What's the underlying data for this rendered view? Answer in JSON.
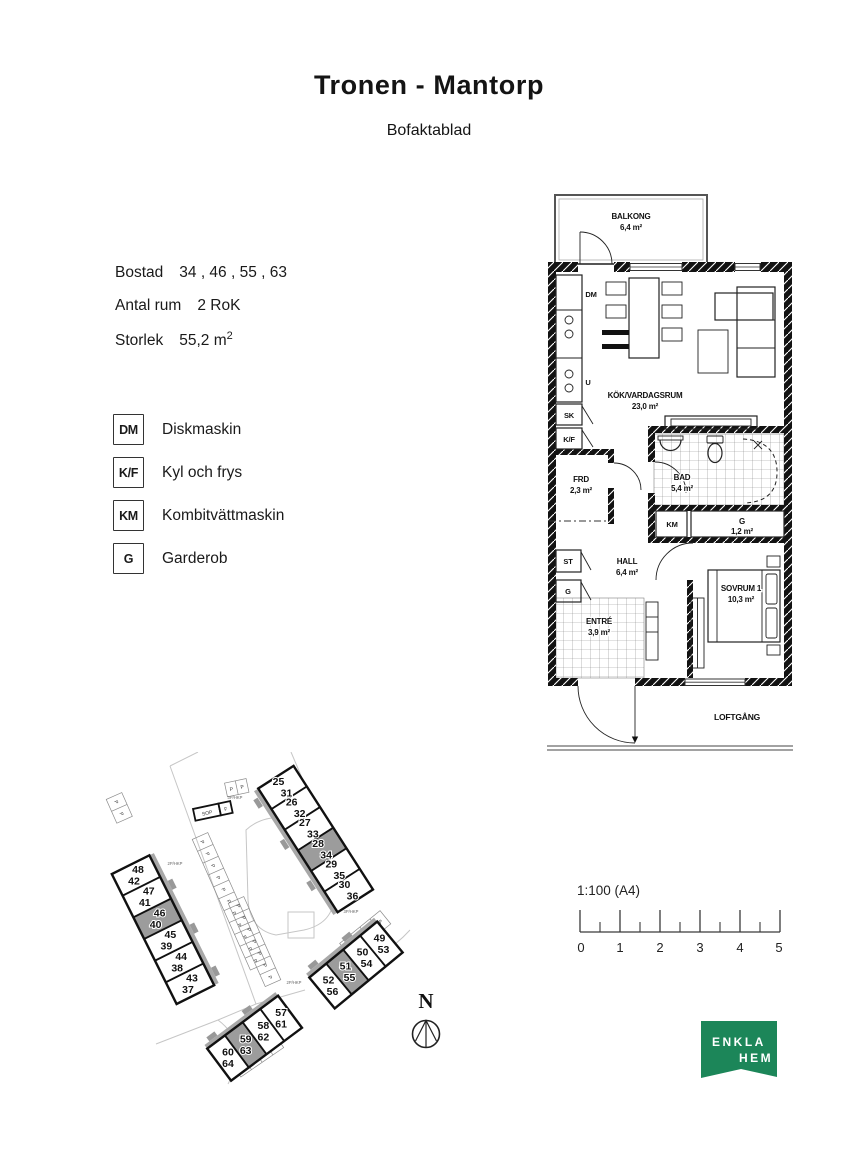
{
  "header": {
    "title": "Tronen - Mantorp",
    "subtitle": "Bofaktablad"
  },
  "info": {
    "rows": [
      {
        "label": "Bostad",
        "value": "34 , 46 , 55 , 63"
      },
      {
        "label": "Antal rum",
        "value": "2 RoK"
      },
      {
        "label": "Storlek",
        "value": "55,2 m",
        "sup": "2"
      }
    ]
  },
  "legend": {
    "items": [
      {
        "symbol": "DM",
        "label": "Diskmaskin"
      },
      {
        "symbol": "K/F",
        "label": "Kyl och frys"
      },
      {
        "symbol": "KM",
        "label": "Kombitvättmaskin"
      },
      {
        "symbol": "G",
        "label": "Garderob"
      }
    ]
  },
  "floorplan": {
    "balcony": {
      "name": "BALKONG",
      "area": "6,4 m²"
    },
    "rooms": {
      "kitchen_living": {
        "name": "KÖK/VARDAGSRUM",
        "area": "23,0 m²"
      },
      "frd": {
        "name": "FRD",
        "area": "2,3 m²"
      },
      "bath": {
        "name": "BAD",
        "area": "5,4 m²"
      },
      "closet": {
        "name": "G",
        "area": "1,2 m²"
      },
      "hall": {
        "name": "HALL",
        "area": "6,4 m²"
      },
      "bedroom": {
        "name": "SOVRUM 1",
        "area": "10,3 m²"
      },
      "entry": {
        "name": "ENTRÉ",
        "area": "3,9 m²"
      }
    },
    "fixtures": {
      "dm": "DM",
      "u": "U",
      "sk": "SK",
      "kf": "K/F",
      "km": "KM",
      "st": "ST",
      "g": "G"
    },
    "walkway": "LOFTGÅNG"
  },
  "siteplan": {
    "highlight_color": "#9c9c9c",
    "parking_label": "P",
    "sop_label": "SOP",
    "f_label": "F",
    "hkp_labels": [
      "3P/HKP",
      "2P/HKP",
      "3P/HKP",
      "2P/HKP"
    ],
    "buildings": [
      {
        "cells": [
          {
            "a": "25",
            "b": "31"
          },
          {
            "a": "26",
            "b": "32"
          },
          {
            "a": "27",
            "b": "33"
          },
          {
            "a": "28",
            "b": "34",
            "highlight": true
          },
          {
            "a": "29",
            "b": "35"
          },
          {
            "a": "30",
            "b": "36"
          }
        ]
      },
      {
        "cells": [
          {
            "a": "48",
            "b": "42"
          },
          {
            "a": "47",
            "b": "41"
          },
          {
            "a": "46",
            "b": "40",
            "highlight": true
          },
          {
            "a": "45",
            "b": "39"
          },
          {
            "a": "44",
            "b": "38"
          },
          {
            "a": "43",
            "b": "37"
          }
        ]
      },
      {
        "cells": [
          {
            "a": "52",
            "b": "56"
          },
          {
            "a": "51",
            "b": "55",
            "highlight": true
          },
          {
            "a": "50",
            "b": "54"
          },
          {
            "a": "49",
            "b": "53"
          }
        ]
      },
      {
        "cells": [
          {
            "a": "60",
            "b": "64"
          },
          {
            "a": "59",
            "b": "63",
            "highlight": true
          },
          {
            "a": "58",
            "b": "62"
          },
          {
            "a": "57",
            "b": "61"
          }
        ]
      }
    ]
  },
  "scalebar": {
    "label": "1:100 (A4)",
    "ticks": [
      "0",
      "1",
      "2",
      "3",
      "4",
      "5"
    ]
  },
  "north": {
    "label": "N"
  },
  "logo": {
    "line1": "ENKLA",
    "line2": "HEM",
    "color": "#1c8659"
  }
}
